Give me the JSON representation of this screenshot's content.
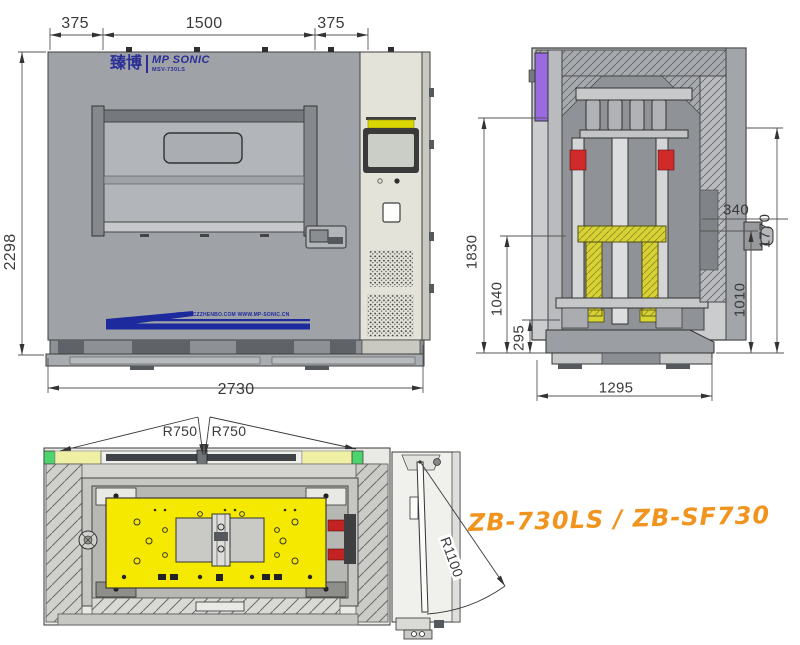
{
  "front_view": {
    "logo": {
      "brand": "臻博",
      "name": "MP SONIC",
      "model": "MSV-730LS"
    },
    "banner_url_text": "WWW.CZZHENBO.COM  WWW.MP-SONIC.CN",
    "dims": {
      "t375l": "375",
      "t1500": "1500",
      "t375r": "375",
      "h2298": "2298",
      "w2730": "2730"
    }
  },
  "side_view": {
    "dims": {
      "h1830": "1830",
      "h1040": "1040",
      "h295": "295",
      "d340": "340",
      "h1770": "1770",
      "h1010": "1010",
      "w1295": "1295"
    }
  },
  "top_view": {
    "dims": {
      "r750_left": "R750",
      "r750_right": "R750",
      "r1100": "R1100"
    }
  },
  "caption": {
    "models": "ZB-730LS / ZB-SF730"
  },
  "colors": {
    "caption_orange": "#F0941E",
    "logo_blue": "#2A2E96",
    "banner_blue": "#1D2A9E",
    "table_yellow": "#F6E900",
    "tool_yellow": "#D8D335",
    "rail_purple": "#9A6BE0",
    "alert_red": "#CC2A2A",
    "screen_cap_yellow": "#D9D600",
    "corner_green": "#4ED46D",
    "strip_pale_yellow": "#F0F0A4"
  }
}
